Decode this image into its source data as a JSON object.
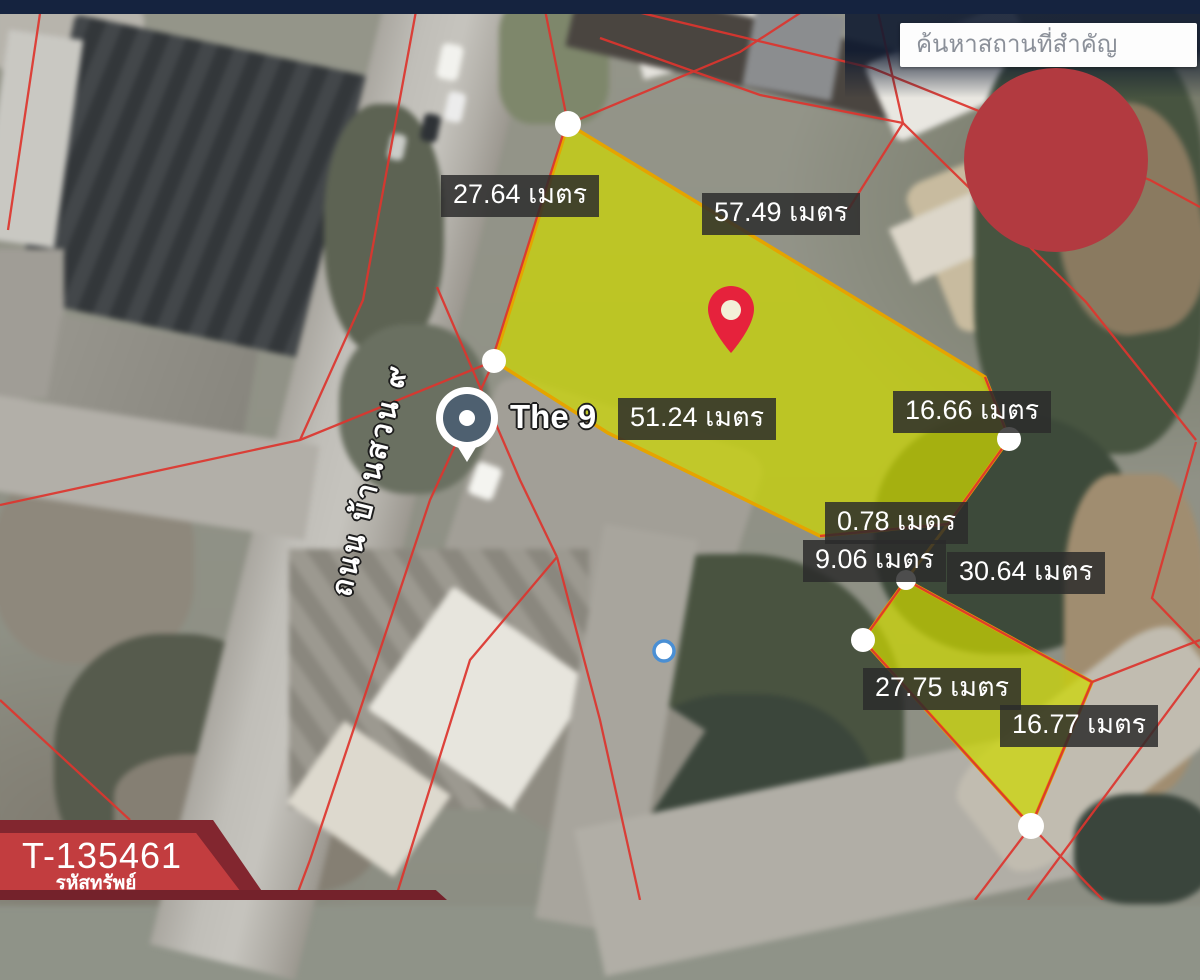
{
  "topbar": {
    "search_placeholder": "ค้นหาสถานที่สำคัญ"
  },
  "map": {
    "road_label": "ถนน บ้านสวน ๙",
    "poi_label": "The 9",
    "pin_caption": "ตำแหน่งแปลงที่ดิน",
    "measurements": [
      {
        "id": "road-frontage",
        "text": "27.64 เมตร"
      },
      {
        "id": "north-edge",
        "text": "57.49 เมตร"
      },
      {
        "id": "south-edge",
        "text": "51.24 เมตร"
      },
      {
        "id": "east-edge",
        "text": "16.66 เมตร"
      },
      {
        "id": "gap-edge-small",
        "text": "0.78 เมตร"
      },
      {
        "id": "gap-edge",
        "text": "9.06 เมตร"
      },
      {
        "id": "plot2-north-edge",
        "text": "30.64 เมตร"
      },
      {
        "id": "plot2-west-edge",
        "text": "27.75 เมตร"
      },
      {
        "id": "plot2-east-edge",
        "text": "16.77 เมตร"
      }
    ]
  },
  "banner": {
    "property_code": "T-135461",
    "caption": "รหัสทรัพย์"
  },
  "colors": {
    "plot_fill": "#cdd800",
    "plot_border": "#e5a400",
    "parcel_line": "#dd352e",
    "brand_red": "#b23a40",
    "banner_red": "#c23d3f",
    "banner_dark_red": "#82262f",
    "navy": "#15233f",
    "pin_red": "#e6223c"
  }
}
